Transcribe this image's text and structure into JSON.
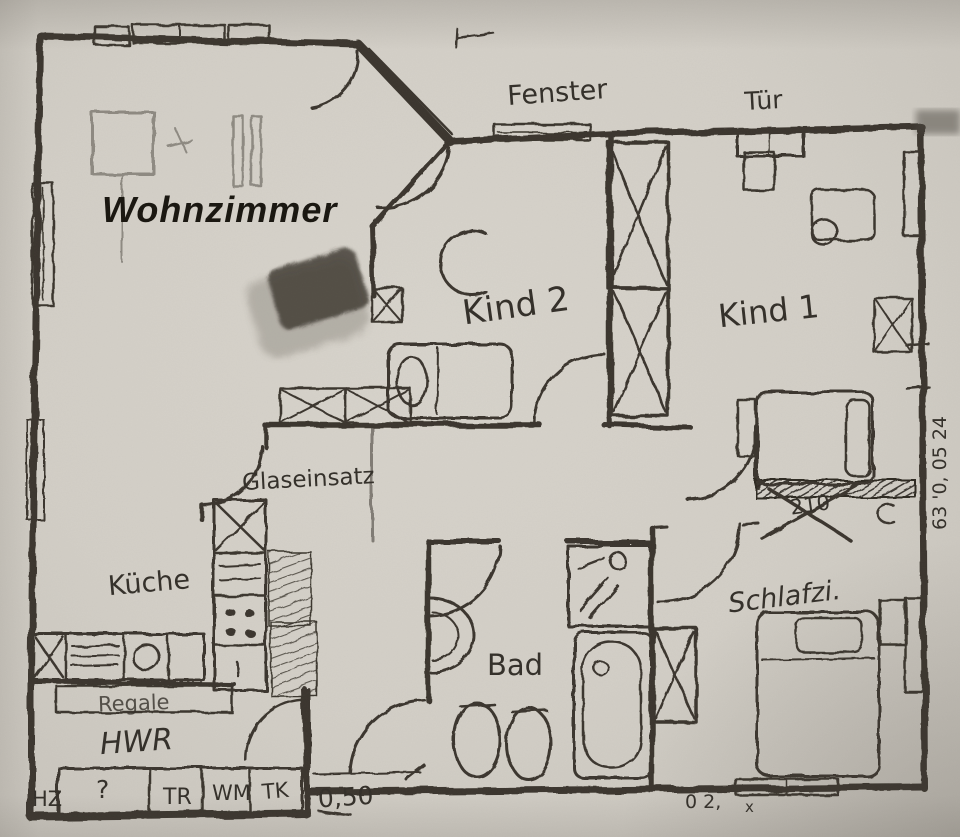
{
  "document": {
    "kind": "hand-drawn apartment floor plan (pencil sketch photo)",
    "language": "German"
  },
  "colors": {
    "paper": "#d3cfc7",
    "pencil": "#3b362e",
    "print_black": "#18150f"
  },
  "rooms": {
    "wohnzimmer": "Wohnzimmer",
    "kind2": "Kind 2",
    "kind1": "Kind 1",
    "kueche": "Küche",
    "schlafzimmer": "Schlafzi.",
    "bad": "Bad",
    "hwr": "HWR"
  },
  "annotations": {
    "fenster": "Fenster",
    "tuer": "Tür",
    "glaseinsatz": "Glaseinsatz",
    "regale": "Regale",
    "dim_050": "0,50",
    "dim_210": "210",
    "side_note": "63 '0, 05 24",
    "bottom_note": "0 2,",
    "bottom_note_2": "x"
  },
  "utility_boxes": {
    "hz": "HZ",
    "unknown": "?",
    "tr": "TR",
    "wm": "WM",
    "tk": "TK"
  }
}
